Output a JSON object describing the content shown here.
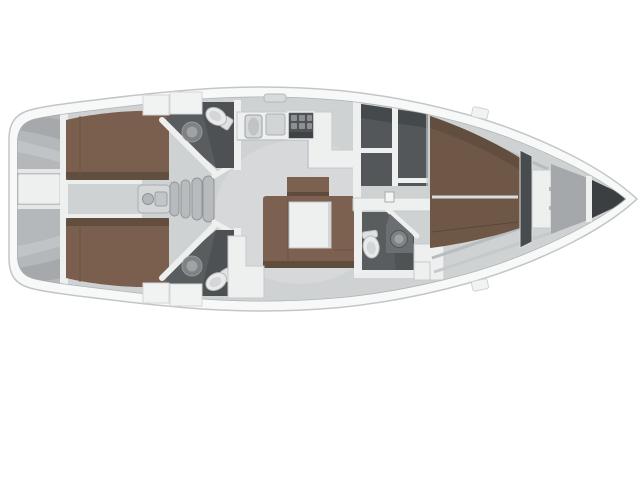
{
  "meta": {
    "alt_text": "Sailing yacht interior layout plan, top view with bow pointing right"
  },
  "colors": {
    "background": "#ffffff",
    "hull_fill": "#f7f8f8",
    "hull_stroke": "#c3c6c8",
    "floor": "#cfd2d3",
    "floor_light": "#dadcdd",
    "inner_shadow": "#a9adaf",
    "wall": "#eef0f0",
    "wall_stroke": "#c6c9cb",
    "stern_gray": "#b4b8ba",
    "berth_brown": "#7a5f4e",
    "berth_brown_dark": "#5e4b3c",
    "vberth_brown": "#6e5746",
    "settee_brown": "#7c6150",
    "table_white": "#eef0f0",
    "dark_room": "#595d60",
    "dark_room_deep": "#43474a",
    "locker_dark": "#53575a",
    "anchor_dark": "#3b3f42",
    "bulkhead_dark": "#484c4f",
    "forepeak_gray": "#a4a8aa",
    "steps_gray": "#b7bbbd",
    "fixture_white": "#e9ebeb",
    "fixture_stroke": "#b6b9bb",
    "sink_gray": "#7e8285",
    "sink_inner": "#9fa3a5",
    "stove_dark": "#4f5356",
    "counter_gray": "#d6d9da",
    "fitting_gray": "#d8dadb",
    "deckbox_white": "#f1f3f3"
  },
  "regions": {
    "plan_title": "Sailing yacht interior layout — top view, bow right",
    "stern_platform": "Stern swim platform and transom lockers",
    "aft_cabin_port": "Aft double cabin (port)",
    "aft_cabin_starboard": "Aft double cabin (starboard)",
    "companionway": "Companionway steps and engine compartment",
    "aft_head_port": "Aft head / WC (port)",
    "aft_head_starboard": "Aft head / WC (starboard)",
    "galley": "L-shaped galley with sink and stove",
    "salon": "Salon with U-shaped settee and table",
    "lockers": "Wardrobe and stowage lockers",
    "forward_head": "Forward head with WC and washbasin",
    "forward_cabin": "Forward cabin with V-berth",
    "forepeak": "Forepeak / anchor locker",
    "mast": "Mast post",
    "deck_fittings": "Deck hatches and fittings"
  }
}
